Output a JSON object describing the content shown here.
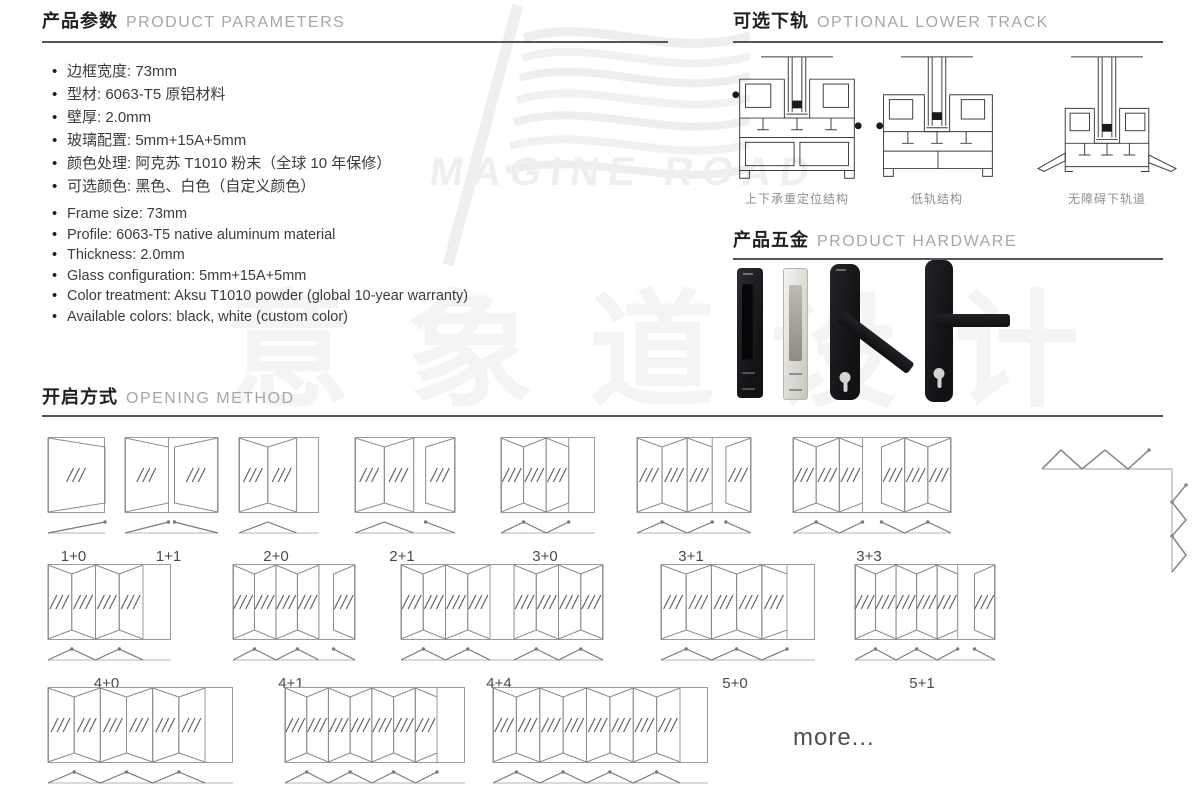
{
  "watermark": {
    "logo_text": "MAGINE ROAD",
    "brand_cn": "意象道设计"
  },
  "parameters": {
    "title_cn": "产品参数",
    "title_en": "PRODUCT PARAMETERS",
    "specs_cn": [
      "边框宽度: 73mm",
      "型材: 6063-T5 原铝材料",
      "壁厚: 2.0mm",
      "玻璃配置: 5mm+15A+5mm",
      "颜色处理: 阿克苏 T1010 粉末（全球 10 年保修）",
      "可选颜色: 黑色、白色（自定义颜色）"
    ],
    "specs_en": [
      "Frame size: 73mm",
      "Profile: 6063-T5 native aluminum material",
      "Thickness: 2.0mm",
      "Glass configuration: 5mm+15A+5mm",
      "Color treatment: Aksu T1010 powder (global 10-year warranty)",
      "Available colors: black, white (custom color)"
    ]
  },
  "lower_track": {
    "title_cn": "可选下轨",
    "title_en": "OPTIONAL LOWER TRACK",
    "tracks": [
      {
        "name": "load-bearing-positioning-track",
        "label_cn": "上下承重定位结构"
      },
      {
        "name": "low-track-structure",
        "label_cn": "低轨结构"
      },
      {
        "name": "barrier-free-lower-track",
        "label_cn": "无障碍下轨道"
      }
    ]
  },
  "hardware": {
    "title_cn": "产品五金",
    "title_en": "PRODUCT HARDWARE",
    "handles": [
      {
        "name": "flush-pull-handle-black"
      },
      {
        "name": "flush-pull-handle-silver"
      },
      {
        "name": "lever-handle-angled-black"
      },
      {
        "name": "lever-handle-flat-black"
      }
    ]
  },
  "opening": {
    "title_cn": "开启方式",
    "title_en": "OPENING METHOD",
    "more_label": "more...",
    "configurations": [
      {
        "label": "1+0",
        "left": 1,
        "right": 0
      },
      {
        "label": "1+1",
        "left": 1,
        "right": 1
      },
      {
        "label": "2+0",
        "left": 2,
        "right": 0
      },
      {
        "label": "2+1",
        "left": 2,
        "right": 1
      },
      {
        "label": "3+0",
        "left": 3,
        "right": 0
      },
      {
        "label": "3+1",
        "left": 3,
        "right": 1
      },
      {
        "label": "3+3",
        "left": 3,
        "right": 3
      },
      {
        "label": "4+0",
        "left": 4,
        "right": 0
      },
      {
        "label": "4+1",
        "left": 4,
        "right": 1
      },
      {
        "label": "4+4",
        "left": 4,
        "right": 4
      },
      {
        "label": "5+0",
        "left": 5,
        "right": 0
      },
      {
        "label": "5+1",
        "left": 5,
        "right": 1
      },
      {
        "label": "6+0",
        "left": 6,
        "right": 0
      },
      {
        "label": "7+0",
        "left": 7,
        "right": 0
      },
      {
        "label": "8+0",
        "left": 8,
        "right": 0
      }
    ],
    "corner_config_name": "corner-folding-layout"
  }
}
